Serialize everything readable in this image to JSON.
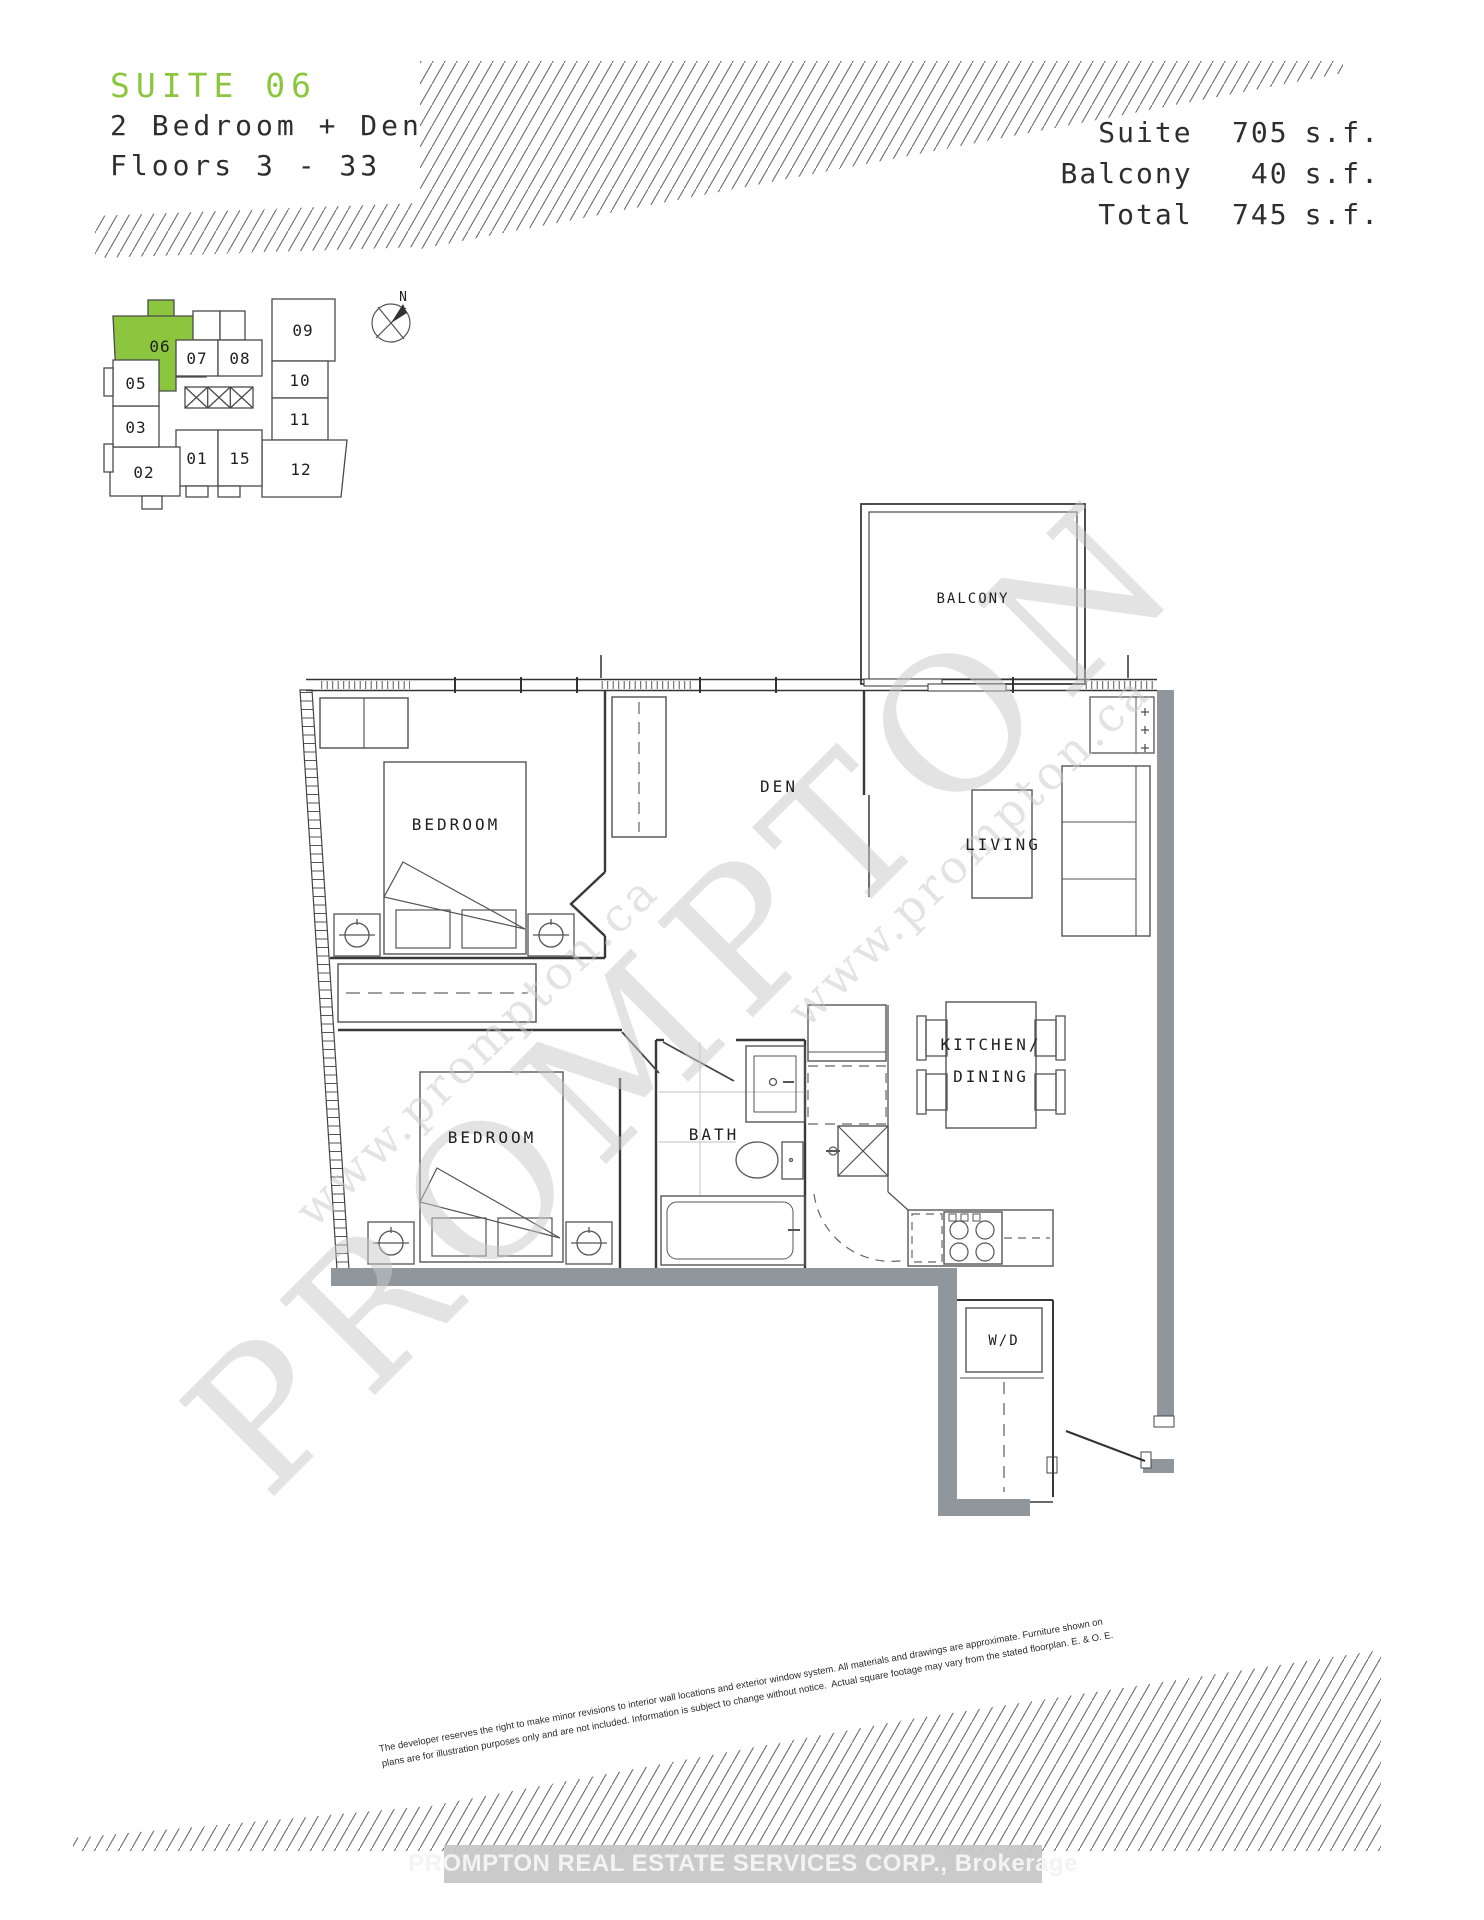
{
  "header": {
    "suite_label": "SUITE 06",
    "type_line": "2 Bedroom + Den",
    "floors_line": "Floors 3 - 33",
    "areas": [
      {
        "label": "Suite",
        "value": "705",
        "unit": "s.f."
      },
      {
        "label": "Balcony",
        "value": "40",
        "unit": "s.f."
      },
      {
        "label": "Total",
        "value": "745",
        "unit": "s.f."
      }
    ]
  },
  "keyplan": {
    "highlighted_suite": "06",
    "compass": "N",
    "suites": {
      "s06": "06",
      "s07": "07",
      "s08": "08",
      "s09": "09",
      "s10": "10",
      "s11": "11",
      "s12": "12",
      "s01": "01",
      "s15": "15",
      "s02": "02",
      "s03": "03",
      "s05": "05"
    }
  },
  "floorplan": {
    "rooms": {
      "balcony": "BALCONY",
      "bedroom1": "BEDROOM",
      "den": "DEN",
      "living": "LIVING",
      "bedroom2": "BEDROOM",
      "bath": "BATH",
      "kitchen_line1": "KITCHEN/",
      "kitchen_line2": "DINING",
      "wd": "W/D"
    }
  },
  "watermark": {
    "primary": "PROMPTON",
    "secondary": "www.prompton.ca"
  },
  "disclaimer": {
    "line1": "The developer reserves the right to make minor revisions to interior wall locations and exterior window system. All materials and drawings are approximate. Furniture shown on",
    "line2": "plans are for illustration purposes only and are not included. Information is subject to change without notice.  Actual square footage may vary from the stated floorplan. E. & O. E."
  },
  "footer": {
    "brokerage": "PROMPTON REAL ESTATE SERVICES CORP., Brokerage"
  },
  "colors": {
    "accent_green": "#8CC63F",
    "wall_gray": "#8F979C"
  }
}
